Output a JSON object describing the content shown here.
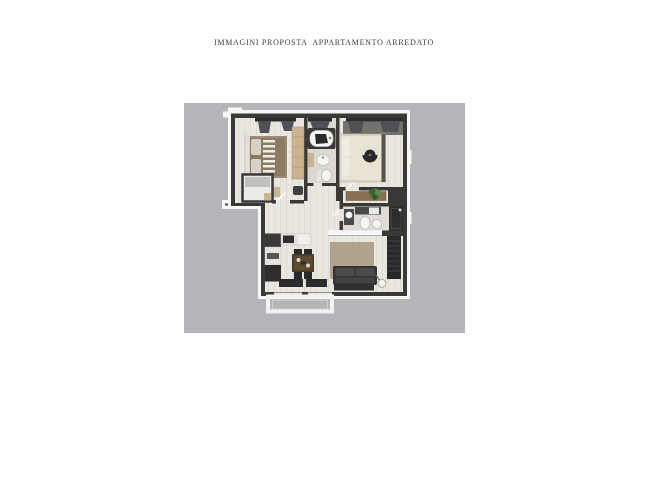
{
  "page": {
    "title": "IMMAGINI PROPOSTA  APPARTAMENTO ARREDATO",
    "background": "#ffffff",
    "title_color": "#3a3a3a"
  },
  "panel": {
    "background": "#b5b4b8",
    "x": 184,
    "y": 103,
    "width": 281,
    "height": 230
  },
  "floorplan": {
    "type": "furnished-apartment-top-view-render",
    "colors": {
      "wall": "#3a3938",
      "trim": "#f7f7f5",
      "floor": "#eae7e0",
      "tan": "#cbb590",
      "brown": "#8a6f52",
      "duvet": "#8b7b63",
      "cream": "#e8e3d5",
      "rug": "#b1a28b",
      "sofa": "#353537",
      "fixture": "#f5f5f3",
      "dark": "#2d2d2f",
      "curtain": "#505056",
      "green": "#4e7a3c",
      "closet": "#edece8",
      "shadow": "#74726c"
    },
    "rooms": [
      {
        "name": "bedroom-1"
      },
      {
        "name": "walk-in-closet"
      },
      {
        "name": "bathroom-1"
      },
      {
        "name": "bedroom-2"
      },
      {
        "name": "hallway"
      },
      {
        "name": "bathroom-2"
      },
      {
        "name": "living-room-kitchen"
      },
      {
        "name": "balcony"
      }
    ]
  }
}
